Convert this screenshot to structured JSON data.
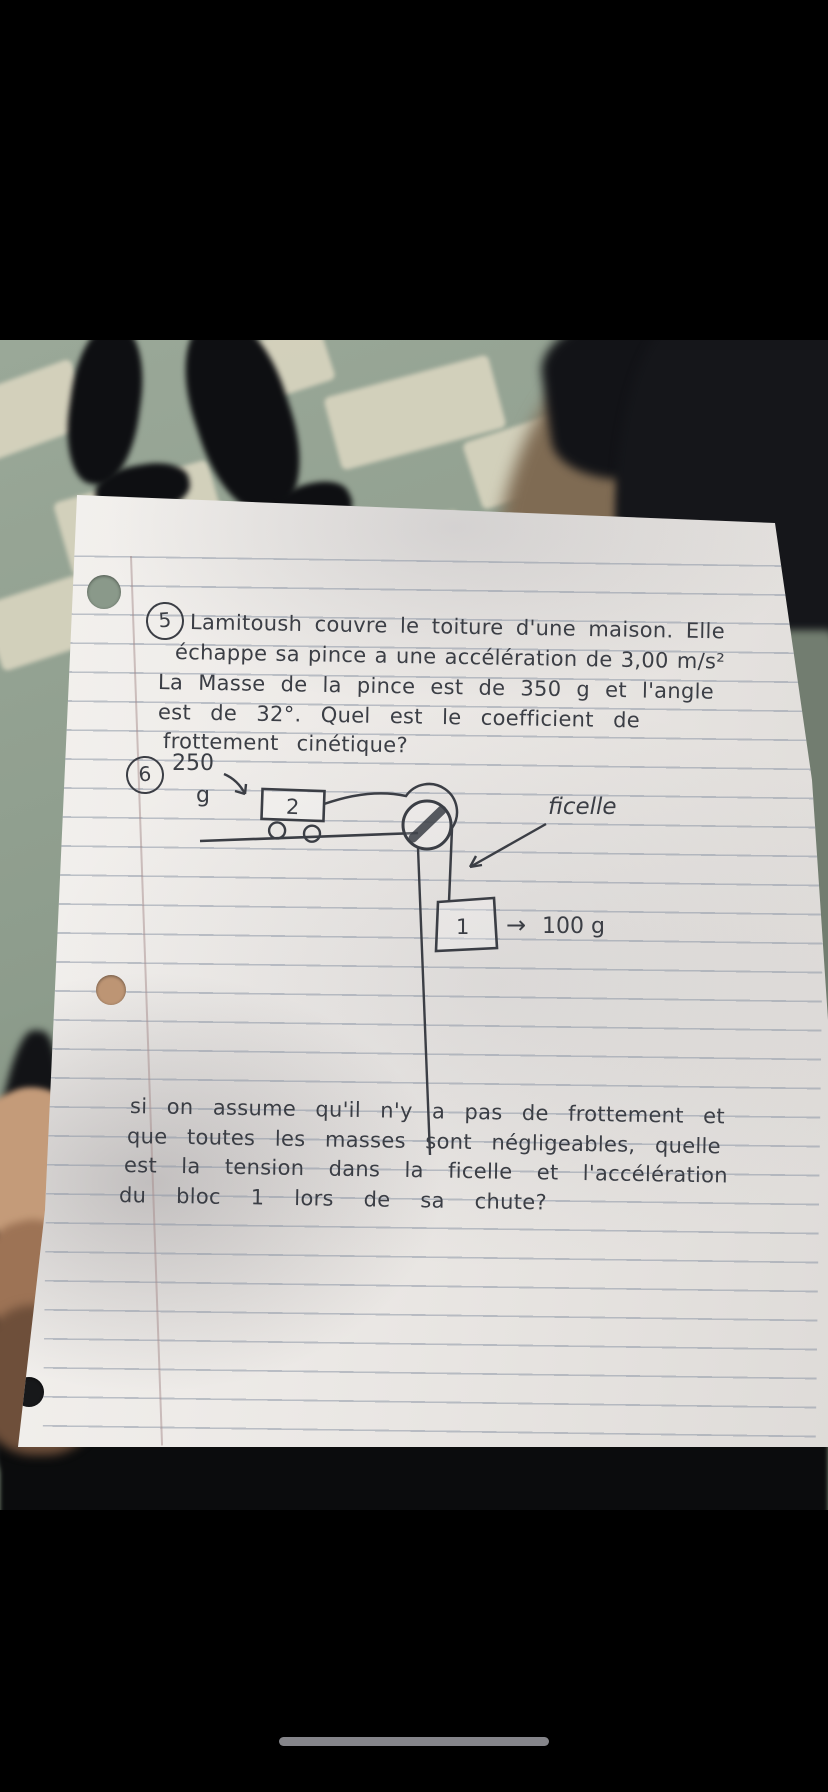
{
  "colors": {
    "floor_green": "#8d9c8c",
    "tile_cream": "#d8d4bf",
    "paper_white": "#ece9e6",
    "ink": "#3b3e45",
    "rule_line": "#8a94a4",
    "skin": "#c49b79",
    "silhouette_black": "#141518",
    "home_indicator": "#85858a"
  },
  "problem5": {
    "number": "5",
    "lines": [
      "Lamitoush couvre le toiture d'une maison. Elle",
      "échappe sa pince a une accélération de 3,00 m/s²",
      "La Masse de la pince est de 350 g et l'angle",
      "est de 32°. Quel est le coefficient de",
      "frottement cinétique?"
    ]
  },
  "problem6": {
    "number": "6",
    "cart_mass_value": "250",
    "cart_mass_unit": "g",
    "cart_label": "2",
    "string_label": "ficelle",
    "block_label": "1",
    "block_arrow": "→",
    "block_mass": "100 g",
    "question_lines": [
      "si on assume qu'il n'y a pas de frottement et",
      "que toutes les masses sont négligeables, quelle",
      "est la tension dans la ficelle et l'accélération",
      "du bloc 1 lors de sa chute?"
    ]
  }
}
